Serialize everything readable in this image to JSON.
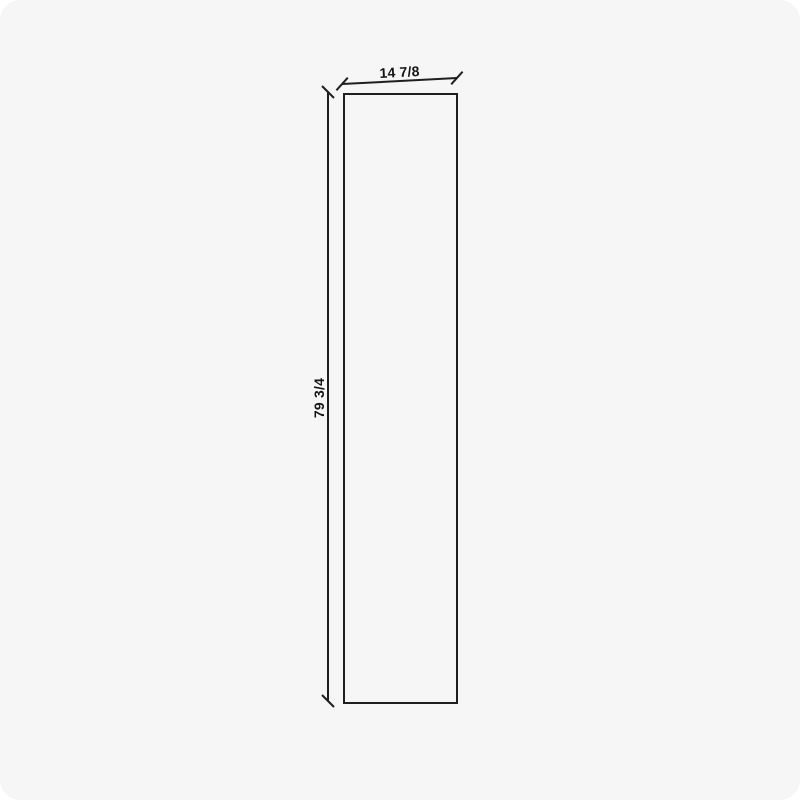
{
  "drawing": {
    "type": "panel-elevation",
    "width_label": "14 7/8",
    "height_label": "79 3/4"
  },
  "colors": {
    "page_background": "#ffffff",
    "panel_background": "#f5f6f5",
    "line": "#1f1f1f",
    "text": "#141414"
  }
}
